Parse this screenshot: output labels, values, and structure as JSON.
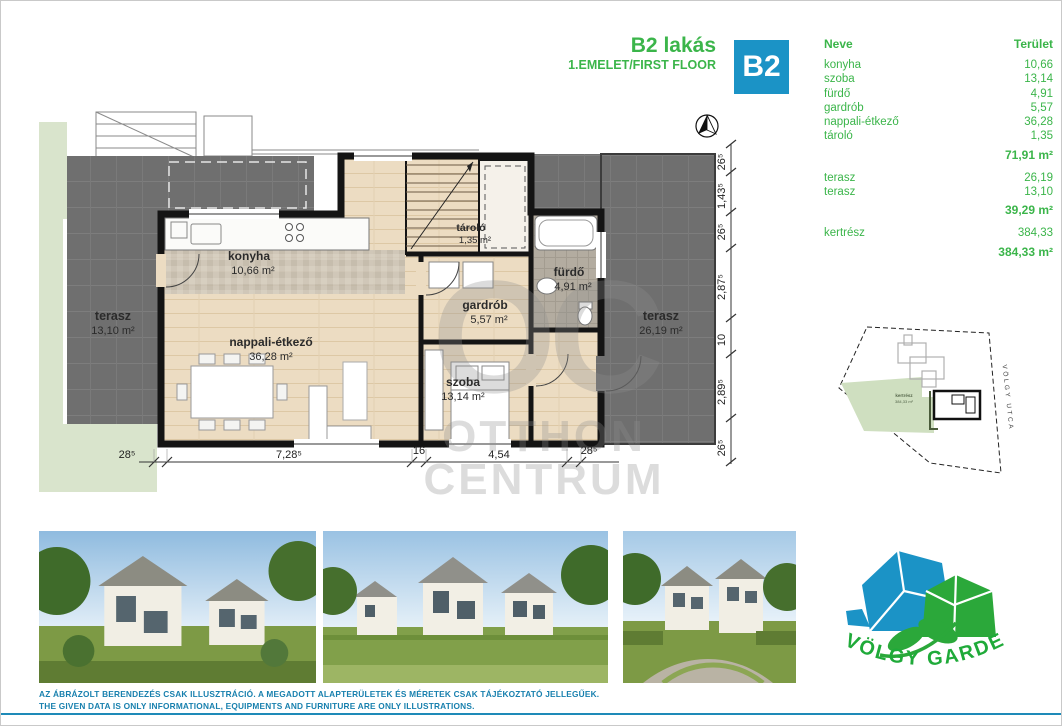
{
  "header": {
    "title": "B2 lakás",
    "subtitle": "1.EMELET/FIRST FLOOR",
    "badge": "B2"
  },
  "area_table": {
    "col_name": "Neve",
    "col_area": "Terület",
    "groups": [
      {
        "rows": [
          {
            "name": "konyha",
            "area": "10,66"
          },
          {
            "name": "szoba",
            "area": "13,14"
          },
          {
            "name": "fürdő",
            "area": "4,91"
          },
          {
            "name": "gardrób",
            "area": "5,57"
          },
          {
            "name": "nappali-étkező",
            "area": "36,28"
          },
          {
            "name": "tároló",
            "area": "1,35"
          }
        ],
        "subtotal": "71,91 m²"
      },
      {
        "rows": [
          {
            "name": "terasz",
            "area": "26,19"
          },
          {
            "name": "terasz",
            "area": "13,10"
          }
        ],
        "subtotal": "39,29 m²"
      },
      {
        "rows": [
          {
            "name": "kertrész",
            "area": "384,33"
          }
        ],
        "subtotal": "384,33 m²"
      }
    ]
  },
  "floor_plan": {
    "rooms": [
      {
        "label": "konyha",
        "area": "10,66 m²"
      },
      {
        "label": "nappali-étkező",
        "area": "36,28 m²"
      },
      {
        "label": "tároló",
        "area": "1,35 m²"
      },
      {
        "label": "fürdő",
        "area": "4,91 m²"
      },
      {
        "label": "gardrób",
        "area": "5,57 m²"
      },
      {
        "label": "szoba",
        "area": "13,14 m²"
      },
      {
        "label": "terasz",
        "area": "13,10 m²"
      },
      {
        "label": "terasz",
        "area": "26,19 m²"
      }
    ],
    "dimensions_bottom": [
      "28⁵",
      "7,28⁵",
      "16",
      "4,54",
      "28⁵"
    ],
    "dimensions_right": [
      "26⁵",
      "1,43⁵",
      "26⁵",
      "2,87⁵",
      "10",
      "2,89⁵",
      "26⁵"
    ],
    "watermark": {
      "monogram": "OC",
      "line1": "OTTHON",
      "line2": "CENTRUM"
    }
  },
  "site_plan": {
    "garden_label": "kertrész",
    "garden_area": "384,33 m²",
    "street": "VÖLGY UTCA"
  },
  "logo": {
    "text": "VÖLGY GARDEN"
  },
  "disclaimer": {
    "line1": "AZ ÁBRÁZOLT BERENDEZÉS CSAK ILLUSZTRÁCIÓ. A MEGADOTT ALAPTERÜLETEK ÉS MÉRETEK CSAK TÁJÉKOZTATÓ JELLEGŰEK.",
    "line2": "THE GIVEN DATA IS ONLY INFORMATIONAL, EQUIPMENTS AND FURNITURE ARE ONLY ILLUSTRATIONS."
  },
  "colors": {
    "brand_green": "#3bb54a",
    "badge_blue": "#1b93c6",
    "disclaimer_blue": "#1880ae",
    "wall_black": "#141414",
    "wood_floor": "#ecdcc2",
    "terrace_gray": "#6f6f6f",
    "garden_green": "#d9e4cc"
  }
}
